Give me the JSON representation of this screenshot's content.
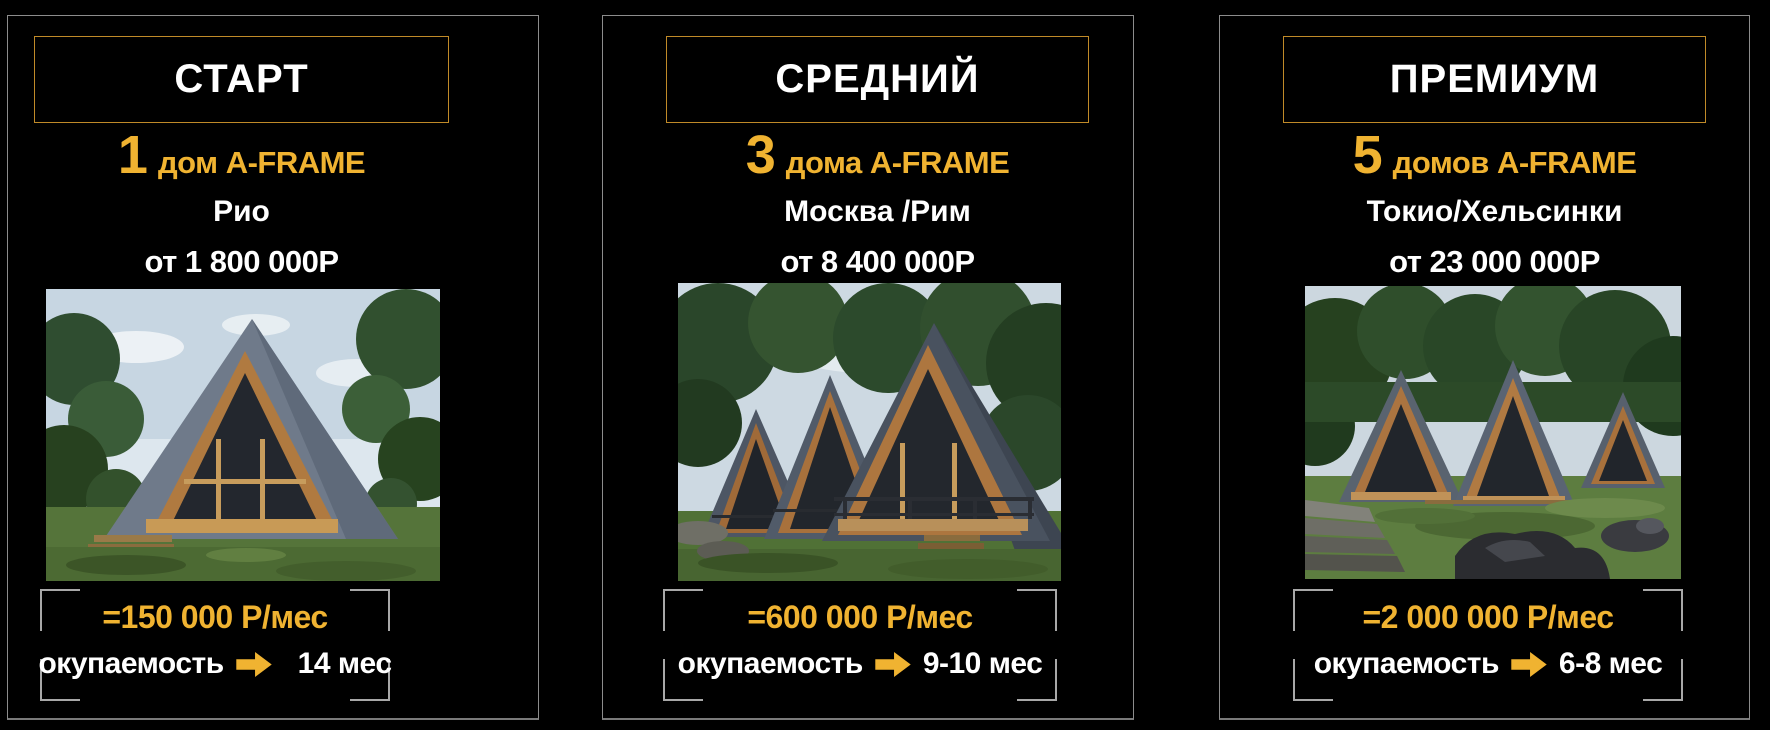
{
  "colors": {
    "background": "#000000",
    "gold": "#f0b331",
    "white": "#ffffff",
    "card_border": "#8c8c8c",
    "title_box_border": "#c08a28",
    "bracket": "#a8a8a8"
  },
  "cards": [
    {
      "title": "СТАРТ",
      "count": "1",
      "count_label": "дом A-FRAME",
      "location": "Рио",
      "price": "от 1 800 000Р",
      "monthly": "=150 000 Р/мес",
      "payback_label": "окупаемость",
      "payback_value": "14 мес",
      "photo_alt": "Одиночный дом A-FRAME в лесу"
    },
    {
      "title": "СРЕДНИЙ",
      "count": "3",
      "count_label": "дома A-FRAME",
      "location": "Москва /Рим",
      "price": "от 8 400 000Р",
      "monthly": "=600 000 Р/мес",
      "payback_label": "окупаемость",
      "payback_value": "9-10 мес",
      "photo_alt": "Три дома A-FRAME в ряд"
    },
    {
      "title": "ПРЕМИУМ",
      "count": "5",
      "count_label": "домов A-FRAME",
      "location": "Токио/Хельсинки",
      "price": "от 23 000 000Р",
      "monthly": "=2 000 000 Р/мес",
      "payback_label": "окупаемость",
      "payback_value": "6-8 мес",
      "photo_alt": "Пять домов A-FRAME на поляне"
    }
  ]
}
